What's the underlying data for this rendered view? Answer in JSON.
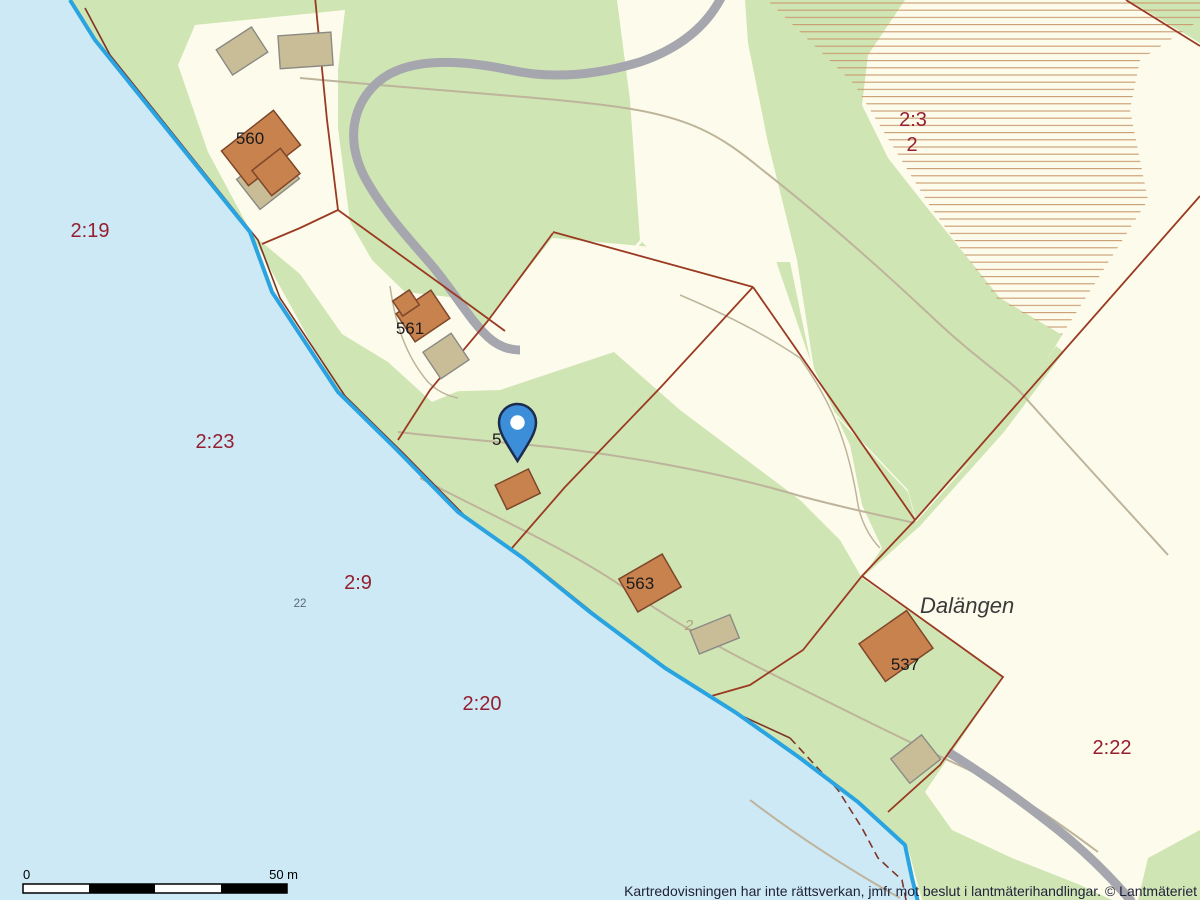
{
  "map": {
    "attribution": "Kartredovisningen har inte rättsverkan, jmfr mot beslut i lantmäterihandlingar. © Lantmäteriet",
    "scale_bar": {
      "zero_label": "0",
      "distance_label": "50 m"
    },
    "place_name": "Dalängen",
    "parcel_labels": {
      "p2_19": "2:19",
      "p2_23": "2:23",
      "p2_9": "2:9",
      "p2_20": "2:20",
      "p2_3": "2:3",
      "p2_3_unit": "2",
      "p2_22": "2:22"
    },
    "building_labels": {
      "b560": "560",
      "b561": "561",
      "b562_partial": "5",
      "b563": "563",
      "b537": "537"
    },
    "annotation_labels": {
      "depth": "22",
      "path": "2"
    },
    "marker": {
      "type": "location-pin"
    },
    "colors": {
      "water": "#cde9f6",
      "land": "#fdfcec",
      "vegetation": "#d0e5b4",
      "road": "#a6a6ae",
      "parcel_line": "#9a3a22",
      "shore_line": "#2aa4e1",
      "shore_border": "#7c3526",
      "hatch_line": "#c89a6e",
      "building": "#c8824e",
      "building_border": "#7e462a",
      "outbuilding": "#c9bd98",
      "outbuilding_border": "#8a8a84",
      "path_line": "#beb49b",
      "parcel_label": "#951f30",
      "building_label": "#1a1a1a",
      "depth_label": "#5a6a74",
      "path_label": "#b3a37c",
      "place_label": "#3a3a3a",
      "attribution_text": "#20223a",
      "pin": "#3d8ed8",
      "pin_border": "#1b2c50"
    }
  }
}
